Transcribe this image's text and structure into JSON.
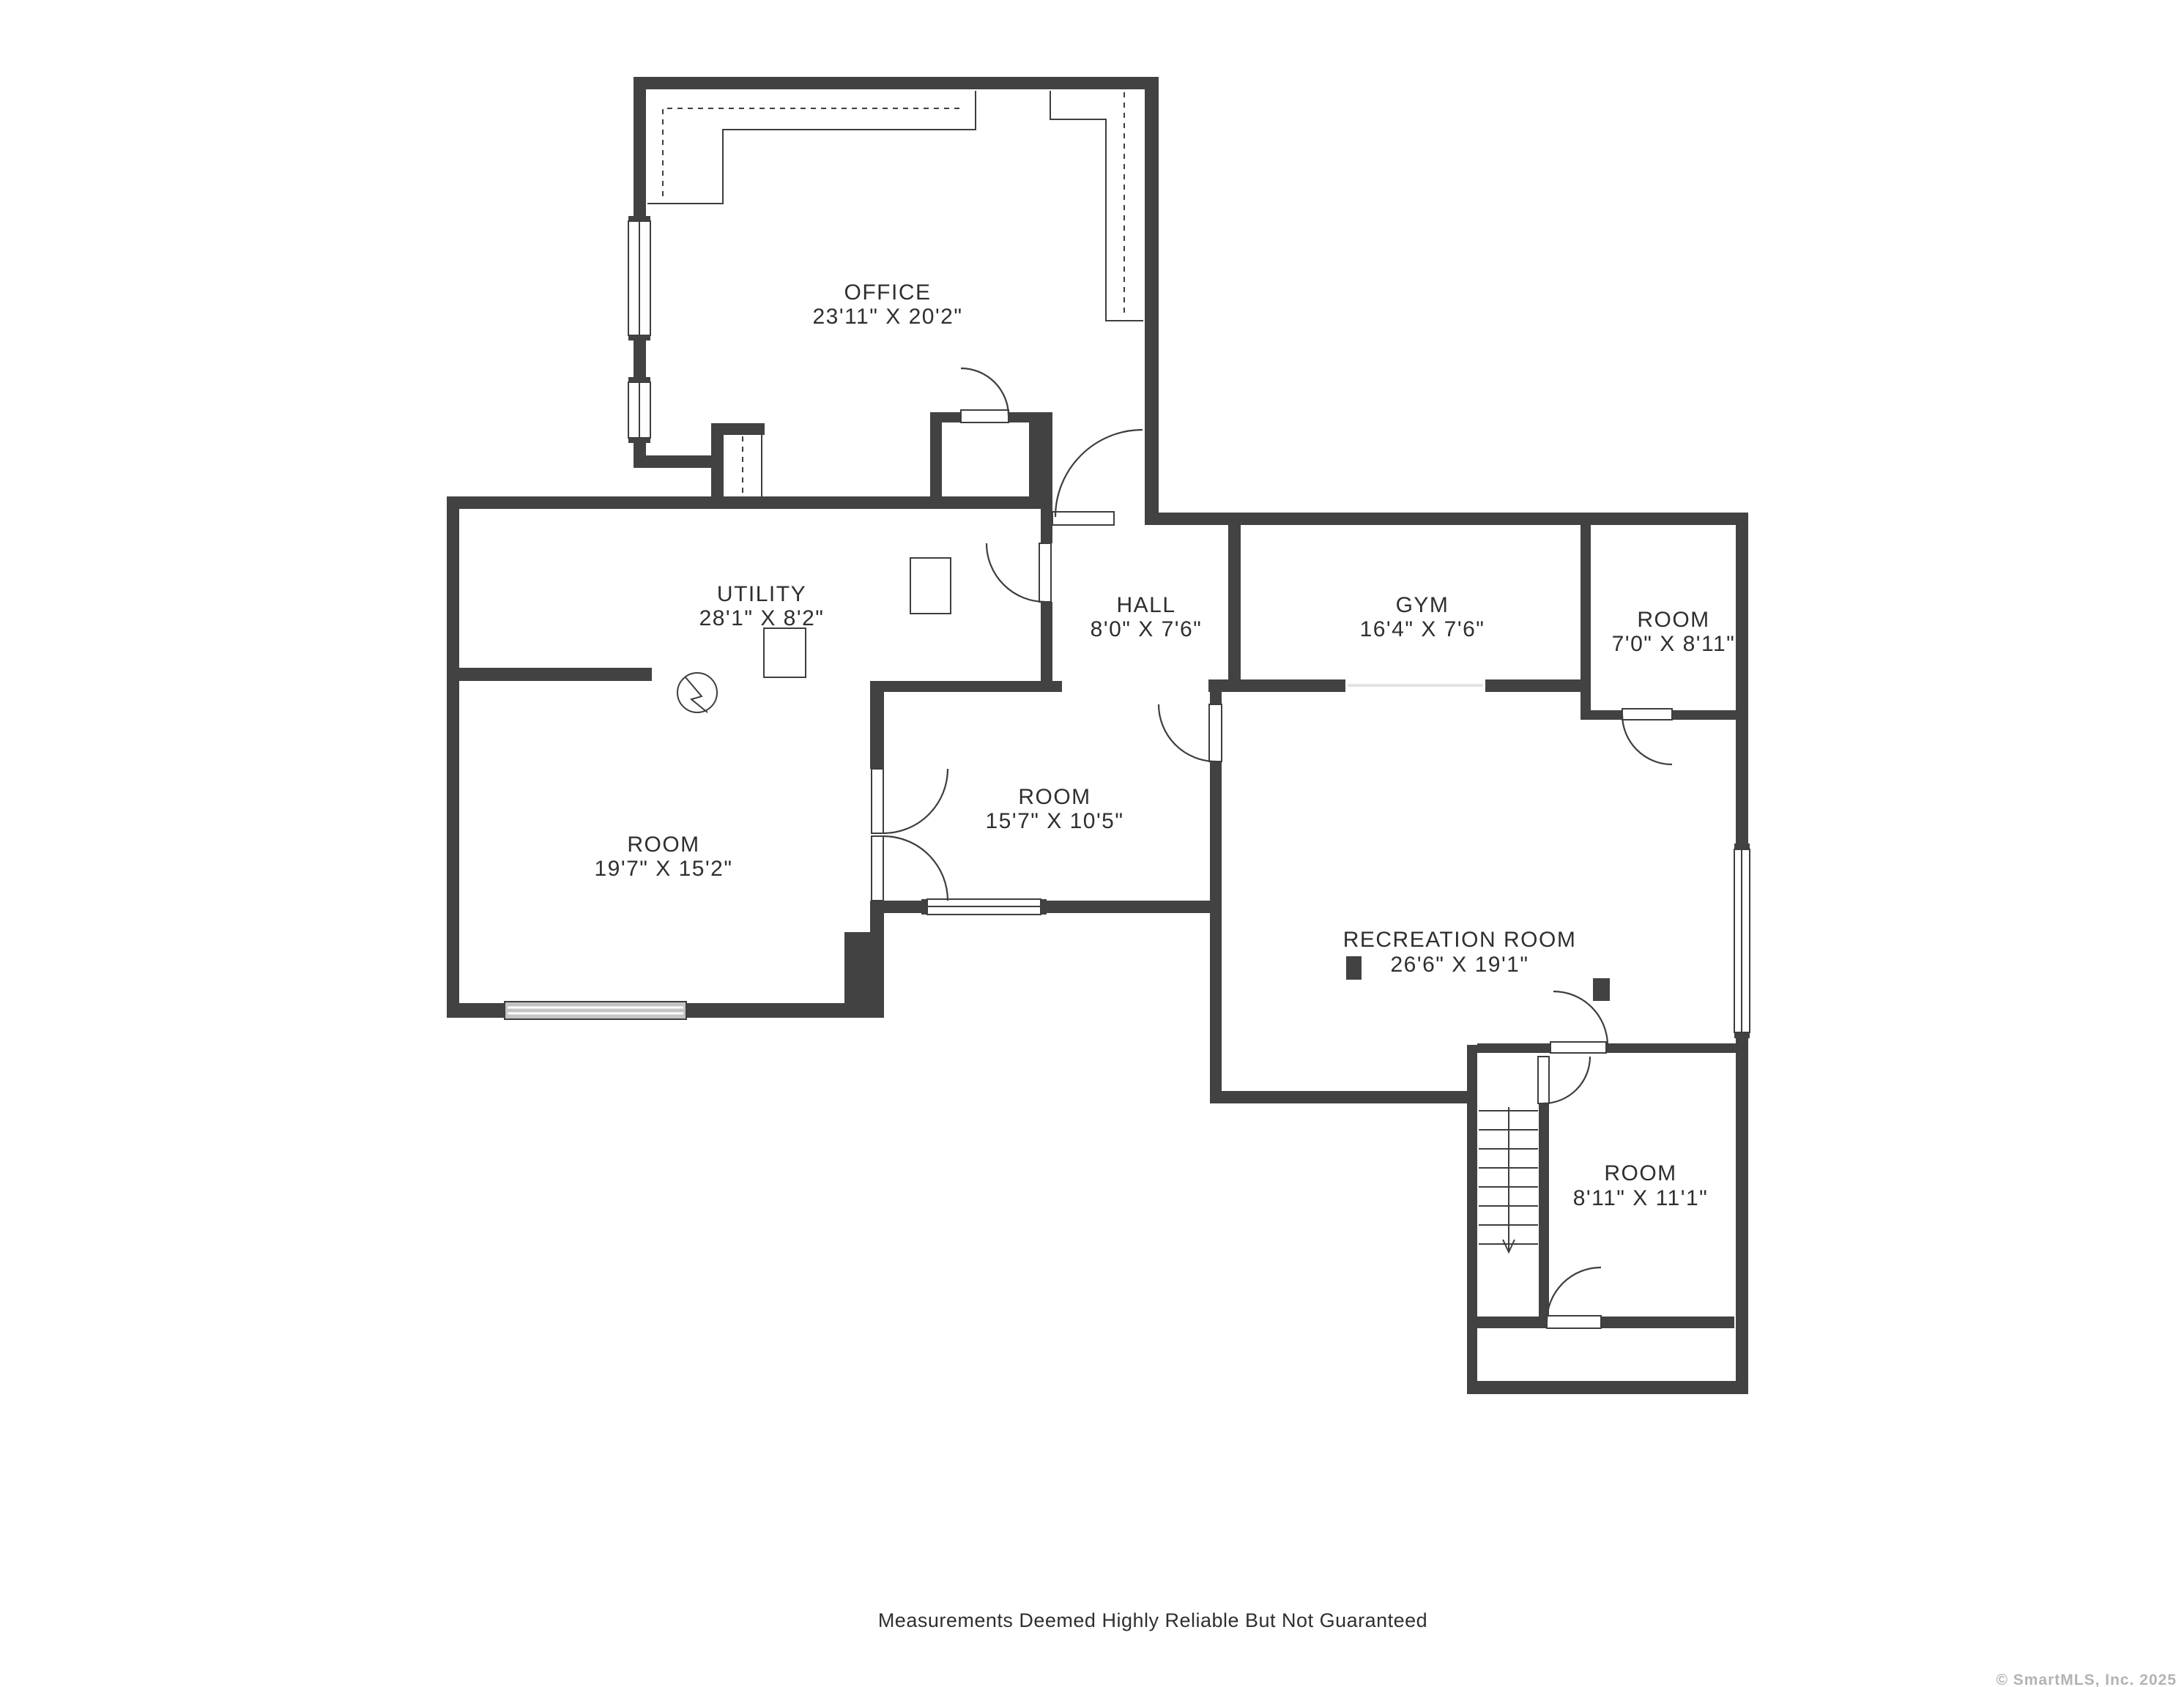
{
  "colors": {
    "wall": "#424242",
    "line": "#3e3e3e",
    "text": "#2f2f2f",
    "copyright": "#b3b3b3",
    "background": "#ffffff"
  },
  "rooms": [
    {
      "name": "OFFICE",
      "dims": "23'11\" X 20'2\""
    },
    {
      "name": "UTILITY",
      "dims": "28'1\" X 8'2\""
    },
    {
      "name": "HALL",
      "dims": "8'0\" X 7'6\""
    },
    {
      "name": "GYM",
      "dims": "16'4\" X 7'6\""
    },
    {
      "name": "ROOM",
      "dims": "7'0\" X 8'11\""
    },
    {
      "name": "ROOM",
      "dims": "19'7\" X 15'2\""
    },
    {
      "name": "ROOM",
      "dims": "15'7\" X 10'5\""
    },
    {
      "name": "RECREATION ROOM",
      "dims": "26'6\" X 19'1\""
    },
    {
      "name": "ROOM",
      "dims": "8'11\" X 11'1\""
    }
  ],
  "footer": {
    "disclaimer": "Measurements Deemed Highly Reliable But Not Guaranteed",
    "copyright": "© SmartMLS, Inc.  2025"
  },
  "symbols": {
    "furnace": "furnace-circle-symbol",
    "stairs": "staircase-down",
    "posts": "support-posts"
  }
}
